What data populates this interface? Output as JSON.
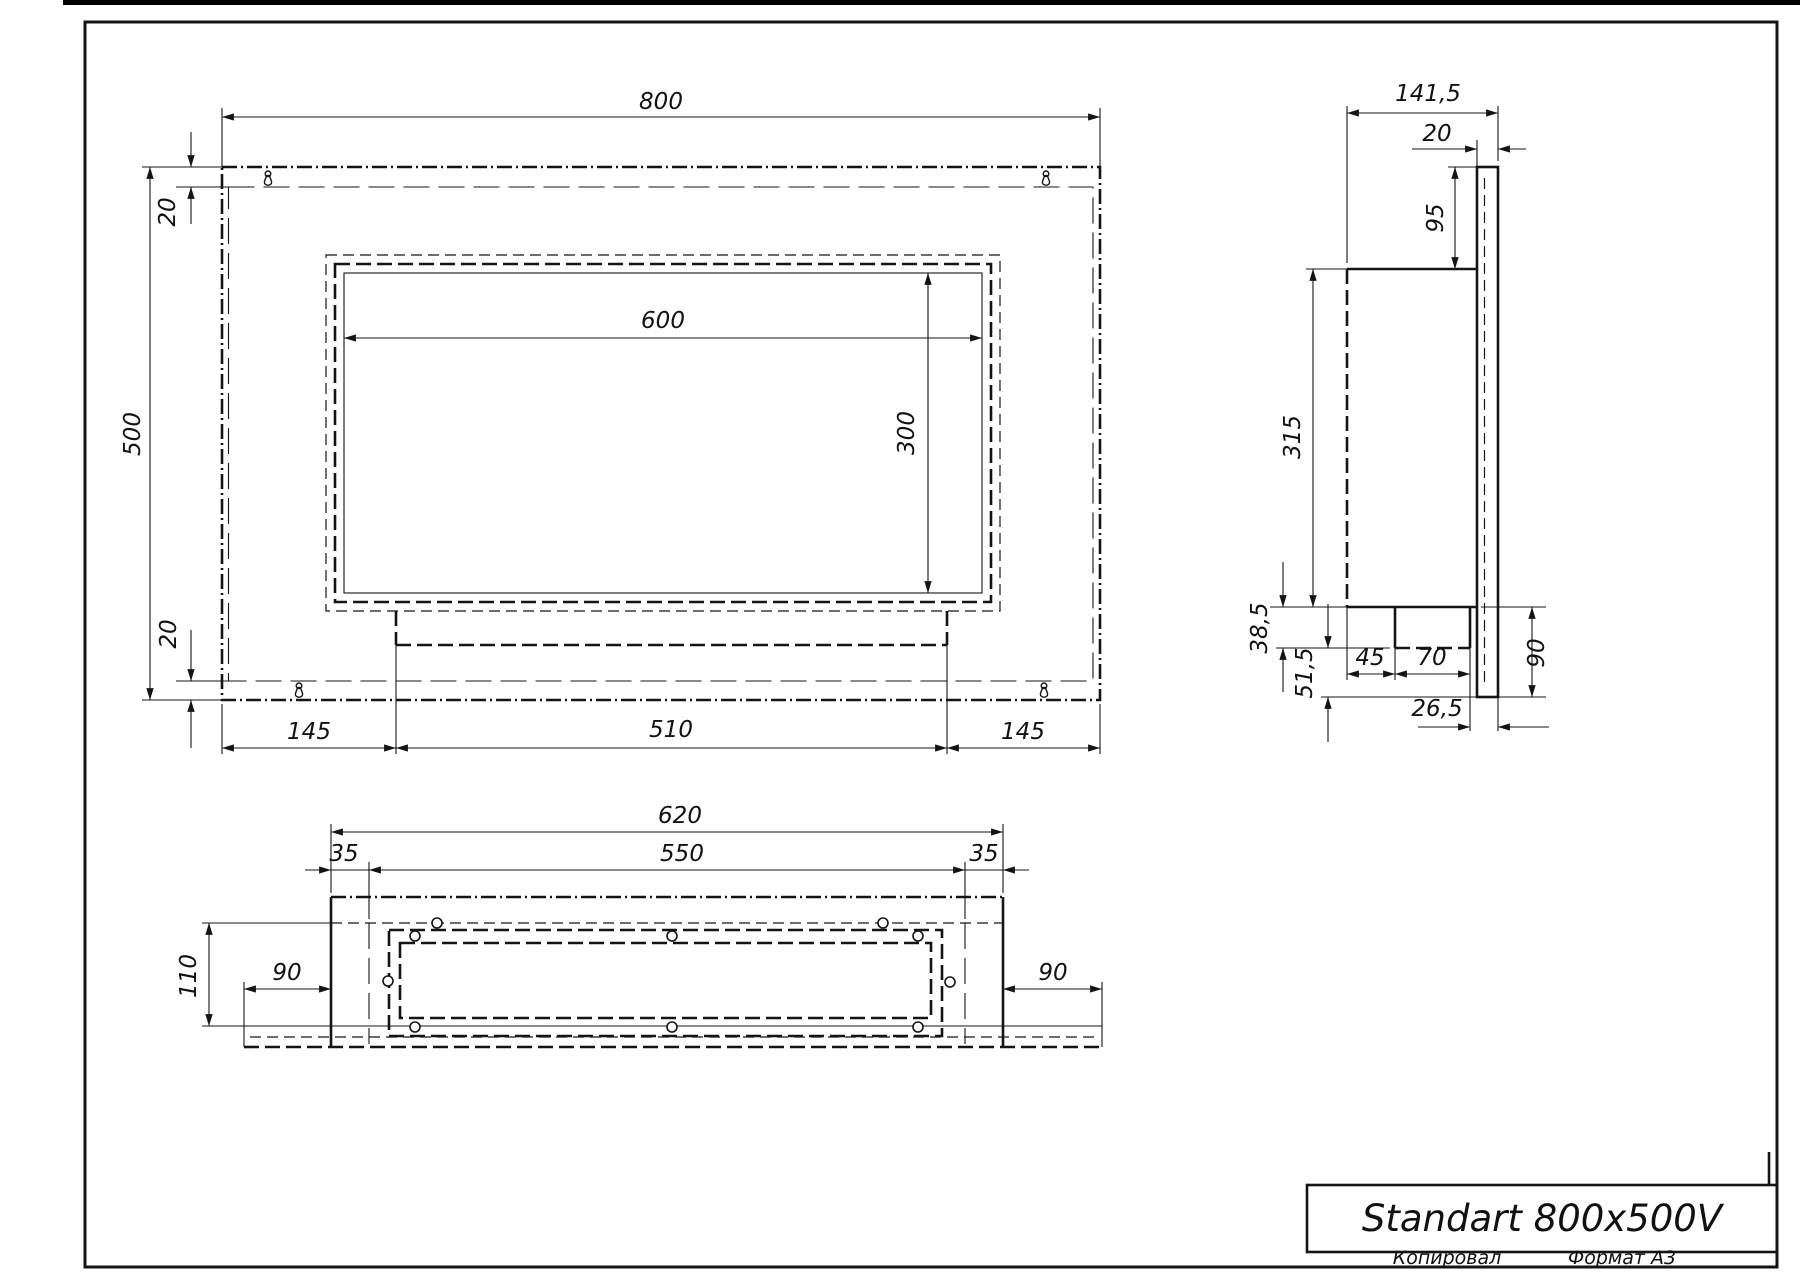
{
  "sheet": {
    "title": "Standart 800x500V",
    "copied_label": "Копировал",
    "format_label": "Формат А3"
  },
  "front_view": {
    "dim_width": "800",
    "dim_height": "500",
    "dim_top_inset": "20",
    "dim_bottom_inset": "20",
    "dim_opening_width": "600",
    "dim_opening_height": "300",
    "dim_bottom_left": "145",
    "dim_bottom_center": "510",
    "dim_bottom_right": "145"
  },
  "side_view": {
    "dim_depth": "141,5",
    "dim_plate_thickness": "20",
    "dim_top_offset": "95",
    "dim_body_height": "315",
    "dim_lip_drop": "38,5",
    "dim_below_lip": "51,5",
    "dim_lip_setback": "45",
    "dim_lip_depth": "70",
    "dim_back_gap": "26,5",
    "dim_plate_below_body": "90"
  },
  "bottom_view": {
    "dim_overall": "620",
    "dim_flange": "550",
    "dim_margin_left": "35",
    "dim_margin_right": "35",
    "dim_depth": "110",
    "dim_wing_left": "90",
    "dim_wing_right": "90"
  }
}
